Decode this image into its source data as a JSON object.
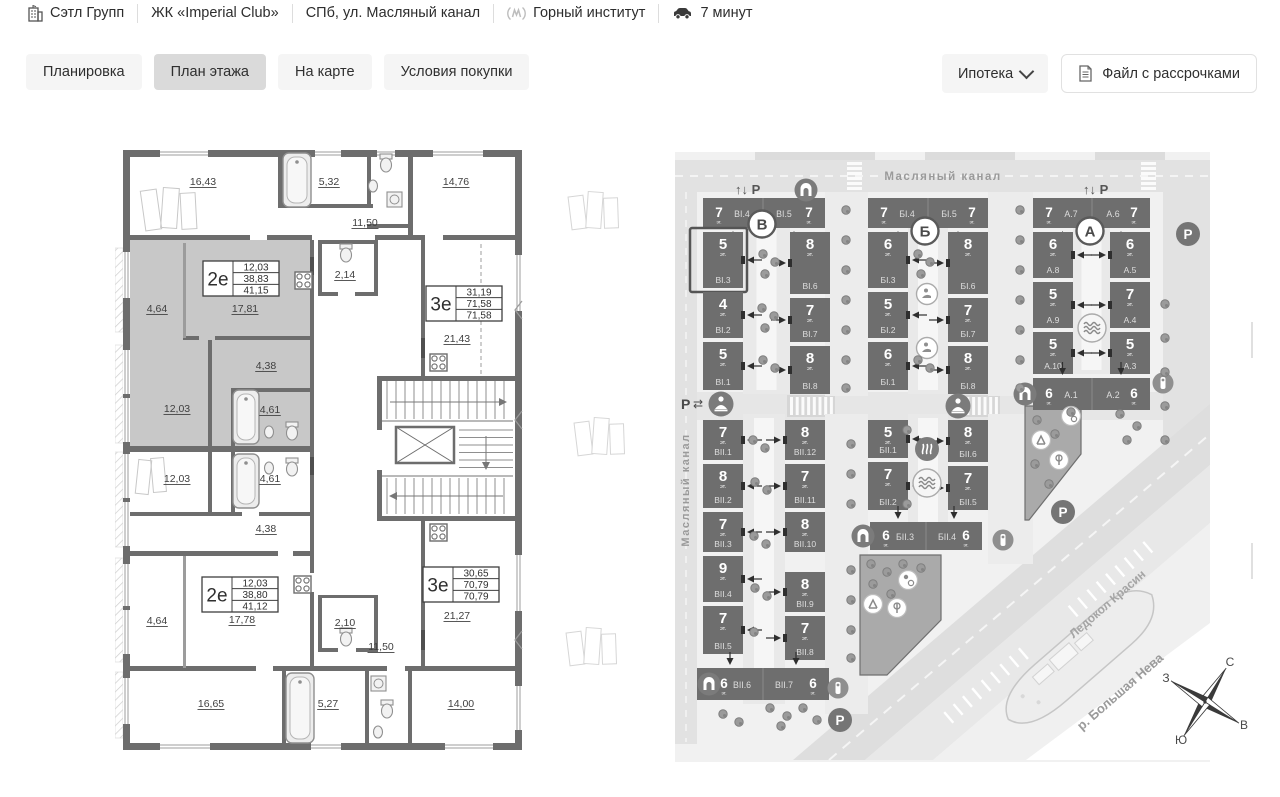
{
  "header": {
    "company": "Сэтл Групп",
    "complex": "ЖК «Imperial Club»",
    "address": "СПб, ул. Масляный канал",
    "metro": "Горный институт",
    "drive_time": "7 минут"
  },
  "tabs": [
    {
      "label": "Планировка",
      "active": false
    },
    {
      "label": "План этажа",
      "active": true
    },
    {
      "label": "На карте",
      "active": false
    },
    {
      "label": "Условия покупки",
      "active": false
    }
  ],
  "toolbar": {
    "mortgage_label": "Ипотека",
    "file_label": "Файл с рассрочками"
  },
  "floor_plan": {
    "unit_cards": [
      {
        "type": "2е",
        "areas": [
          "12,03",
          "38,83",
          "41,15"
        ],
        "x": 88,
        "y": 121
      },
      {
        "type": "3е",
        "areas": [
          "31,19",
          "71,58",
          "71,58"
        ],
        "x": 311,
        "y": 146
      },
      {
        "type": "2е",
        "areas": [
          "12,03",
          "38,80",
          "41,12"
        ],
        "x": 87,
        "y": 437
      },
      {
        "type": "3е",
        "areas": [
          "30,65",
          "70,79",
          "70,79"
        ],
        "x": 308,
        "y": 427
      }
    ],
    "room_labels": [
      {
        "t": "16,43",
        "x": 88,
        "y": 45
      },
      {
        "t": "5,32",
        "x": 214,
        "y": 45
      },
      {
        "t": "14,76",
        "x": 341,
        "y": 45
      },
      {
        "t": "11,50",
        "x": 250,
        "y": 86
      },
      {
        "t": "2,14",
        "x": 230,
        "y": 138
      },
      {
        "t": "4,64",
        "x": 42,
        "y": 172
      },
      {
        "t": "17,81",
        "x": 130,
        "y": 172
      },
      {
        "t": "4,38",
        "x": 151,
        "y": 229
      },
      {
        "t": "12,03",
        "x": 62,
        "y": 272
      },
      {
        "t": "4,61",
        "x": 155,
        "y": 273
      },
      {
        "t": "12,03",
        "x": 62,
        "y": 342
      },
      {
        "t": "4,61",
        "x": 155,
        "y": 342
      },
      {
        "t": "4,38",
        "x": 151,
        "y": 392
      },
      {
        "t": "21,43",
        "x": 342,
        "y": 202
      },
      {
        "t": "21,27",
        "x": 342,
        "y": 479
      },
      {
        "t": "17,78",
        "x": 127,
        "y": 483
      },
      {
        "t": "4,64",
        "x": 42,
        "y": 484
      },
      {
        "t": "2,10",
        "x": 230,
        "y": 486
      },
      {
        "t": "11,50",
        "x": 266,
        "y": 510
      },
      {
        "t": "16,65",
        "x": 96,
        "y": 567
      },
      {
        "t": "5,27",
        "x": 213,
        "y": 567
      },
      {
        "t": "14,00",
        "x": 346,
        "y": 567
      }
    ]
  },
  "site_map": {
    "streets": {
      "top": "Масляный канал",
      "left": "Масляный канал"
    },
    "river_label": "р. Большая Нева",
    "ship_label": "Ледокол Красин",
    "floors_suffix": "эт.",
    "parking_letter": "P",
    "entry_parking_label": "↑↓ P",
    "exchange_glyph": "⇄",
    "compass": {
      "north": "С",
      "east": "В",
      "south": "Ю",
      "west": "З"
    },
    "sections": [
      {
        "letter": "В",
        "x": 87,
        "y": 72
      },
      {
        "letter": "Б",
        "x": 250,
        "y": 79
      },
      {
        "letter": "А",
        "x": 415,
        "y": 79
      }
    ],
    "buildings": [
      {
        "label": "ВI.4",
        "floors": "7",
        "x": 28,
        "y": 46,
        "w": 60,
        "h": 30,
        "style": "nl",
        "entry": "b"
      },
      {
        "label": "ВI.5",
        "floors": "7",
        "x": 88,
        "y": 46,
        "w": 62,
        "h": 30,
        "style": "ln",
        "entry": "b"
      },
      {
        "label": "ВI.3",
        "floors": "5",
        "x": 28,
        "y": 80,
        "w": 40,
        "h": 56,
        "style": "col",
        "entry": "r",
        "selected": true
      },
      {
        "label": "ВI.2",
        "floors": "4",
        "x": 28,
        "y": 140,
        "w": 40,
        "h": 46,
        "style": "col",
        "entry": "r"
      },
      {
        "label": "ВI.1",
        "floors": "5",
        "x": 28,
        "y": 190,
        "w": 40,
        "h": 48,
        "style": "col",
        "entry": "r"
      },
      {
        "label": "ВI.6",
        "floors": "8",
        "x": 115,
        "y": 80,
        "w": 40,
        "h": 62,
        "style": "col",
        "entry": "l"
      },
      {
        "label": "ВI.7",
        "floors": "7",
        "x": 115,
        "y": 146,
        "w": 40,
        "h": 44,
        "style": "col",
        "entry": "l"
      },
      {
        "label": "ВI.8",
        "floors": "8",
        "x": 115,
        "y": 194,
        "w": 40,
        "h": 48,
        "style": "col",
        "entry": "l"
      },
      {
        "label": "БI.4",
        "floors": "7",
        "x": 193,
        "y": 46,
        "w": 60,
        "h": 30,
        "style": "nl",
        "entry": "b"
      },
      {
        "label": "БI.5",
        "floors": "7",
        "x": 253,
        "y": 46,
        "w": 60,
        "h": 30,
        "style": "ln",
        "entry": "b"
      },
      {
        "label": "БI.3",
        "floors": "6",
        "x": 193,
        "y": 80,
        "w": 40,
        "h": 56,
        "style": "col",
        "entry": "r"
      },
      {
        "label": "БI.2",
        "floors": "5",
        "x": 193,
        "y": 140,
        "w": 40,
        "h": 46,
        "style": "col",
        "entry": "r"
      },
      {
        "label": "БI.1",
        "floors": "6",
        "x": 193,
        "y": 190,
        "w": 40,
        "h": 48,
        "style": "col",
        "entry": "r"
      },
      {
        "label": "БI.6",
        "floors": "8",
        "x": 273,
        "y": 80,
        "w": 40,
        "h": 62,
        "style": "col",
        "entry": "l"
      },
      {
        "label": "БI.7",
        "floors": "7",
        "x": 273,
        "y": 146,
        "w": 40,
        "h": 44,
        "style": "col",
        "entry": "l"
      },
      {
        "label": "БI.8",
        "floors": "8",
        "x": 273,
        "y": 194,
        "w": 40,
        "h": 48,
        "style": "col",
        "entry": "l"
      },
      {
        "label": "А.7",
        "floors": "7",
        "x": 358,
        "y": 46,
        "w": 59,
        "h": 30,
        "style": "nl",
        "entry": "b"
      },
      {
        "label": "А.6",
        "floors": "7",
        "x": 417,
        "y": 46,
        "w": 58,
        "h": 30,
        "style": "ln",
        "entry": "b"
      },
      {
        "label": "А.8",
        "floors": "6",
        "x": 358,
        "y": 80,
        "w": 40,
        "h": 46,
        "style": "col",
        "entry": "r"
      },
      {
        "label": "А.9",
        "floors": "5",
        "x": 358,
        "y": 130,
        "w": 40,
        "h": 46,
        "style": "col",
        "entry": "r"
      },
      {
        "label": "А.10",
        "floors": "5",
        "x": 358,
        "y": 180,
        "w": 40,
        "h": 42,
        "style": "col",
        "entry": "r"
      },
      {
        "label": "А.5",
        "floors": "6",
        "x": 435,
        "y": 80,
        "w": 40,
        "h": 46,
        "style": "col",
        "entry": "l"
      },
      {
        "label": "А.4",
        "floors": "7",
        "x": 435,
        "y": 130,
        "w": 40,
        "h": 46,
        "style": "col",
        "entry": "l"
      },
      {
        "label": "А.3",
        "floors": "5",
        "x": 435,
        "y": 180,
        "w": 40,
        "h": 42,
        "style": "col",
        "entry": "l"
      },
      {
        "label": "А.1",
        "floors": "6",
        "x": 358,
        "y": 226,
        "w": 59,
        "h": 32,
        "style": "nl",
        "entry": "t"
      },
      {
        "label": "А.2",
        "floors": "6",
        "x": 417,
        "y": 226,
        "w": 58,
        "h": 32,
        "style": "ln",
        "entry": "t"
      },
      {
        "label": "ВII.1",
        "floors": "7",
        "x": 28,
        "y": 268,
        "w": 40,
        "h": 40,
        "style": "col",
        "entry": "r"
      },
      {
        "label": "ВII.2",
        "floors": "8",
        "x": 28,
        "y": 312,
        "w": 40,
        "h": 44,
        "style": "col",
        "entry": "r"
      },
      {
        "label": "ВII.3",
        "floors": "7",
        "x": 28,
        "y": 360,
        "w": 40,
        "h": 40,
        "style": "col",
        "entry": "r"
      },
      {
        "label": "ВII.4",
        "floors": "9",
        "x": 28,
        "y": 404,
        "w": 40,
        "h": 46,
        "style": "col",
        "entry": "r"
      },
      {
        "label": "ВII.5",
        "floors": "7",
        "x": 28,
        "y": 454,
        "w": 40,
        "h": 48,
        "style": "col",
        "entry": "r"
      },
      {
        "label": "ВII.12",
        "floors": "8",
        "x": 110,
        "y": 268,
        "w": 40,
        "h": 40,
        "style": "col",
        "entry": "l"
      },
      {
        "label": "ВII.11",
        "floors": "7",
        "x": 110,
        "y": 312,
        "w": 40,
        "h": 44,
        "style": "col",
        "entry": "l"
      },
      {
        "label": "ВII.10",
        "floors": "8",
        "x": 110,
        "y": 360,
        "w": 40,
        "h": 40,
        "style": "col",
        "entry": "l"
      },
      {
        "label": "ВII.9",
        "floors": "8",
        "x": 110,
        "y": 420,
        "w": 40,
        "h": 40,
        "style": "col",
        "entry": "l"
      },
      {
        "label": "ВII.8",
        "floors": "7",
        "x": 110,
        "y": 464,
        "w": 40,
        "h": 44,
        "style": "col",
        "entry": "l"
      },
      {
        "label": "ВII.6",
        "floors": "6",
        "x": 22,
        "y": 516,
        "w": 66,
        "h": 32,
        "style": "nl",
        "entry": "t",
        "nx": 27
      },
      {
        "label": "ВII.7",
        "floors": "6",
        "x": 88,
        "y": 516,
        "w": 66,
        "h": 32,
        "style": "ln",
        "entry": "t"
      },
      {
        "label": "БII.1",
        "floors": "5",
        "x": 193,
        "y": 268,
        "w": 40,
        "h": 38,
        "style": "col",
        "entry": "r"
      },
      {
        "label": "БII.2",
        "floors": "7",
        "x": 193,
        "y": 310,
        "w": 40,
        "h": 48,
        "style": "col",
        "entry": "r"
      },
      {
        "label": "БII.6",
        "floors": "8",
        "x": 273,
        "y": 268,
        "w": 40,
        "h": 42,
        "style": "col",
        "entry": "l"
      },
      {
        "label": "БII.5",
        "floors": "7",
        "x": 273,
        "y": 314,
        "w": 40,
        "h": 44,
        "style": "col",
        "entry": "l"
      },
      {
        "label": "БII.3",
        "floors": "6",
        "x": 195,
        "y": 370,
        "w": 56,
        "h": 28,
        "style": "nl",
        "entry": "t"
      },
      {
        "label": "БII.4",
        "floors": "6",
        "x": 251,
        "y": 370,
        "w": 56,
        "h": 28,
        "style": "ln",
        "entry": "t"
      }
    ],
    "features": [
      {
        "type": "entry-parking",
        "x": 60,
        "y": 42
      },
      {
        "type": "entry-parking",
        "x": 408,
        "y": 42
      },
      {
        "type": "parking",
        "x": 513,
        "y": 82
      },
      {
        "type": "parking",
        "x": 388,
        "y": 360
      },
      {
        "type": "parking",
        "x": 165,
        "y": 568
      },
      {
        "type": "side-parking",
        "x": 6,
        "y": 257
      },
      {
        "type": "yoga",
        "x": 46,
        "y": 252
      },
      {
        "type": "yoga",
        "x": 283,
        "y": 254
      },
      {
        "type": "spa",
        "x": 252,
        "y": 142
      },
      {
        "type": "spa",
        "x": 252,
        "y": 196
      },
      {
        "type": "hammam",
        "x": 252,
        "y": 297
      },
      {
        "type": "pool",
        "x": 252,
        "y": 331
      },
      {
        "type": "pool",
        "x": 417,
        "y": 176
      },
      {
        "type": "info",
        "x": 488,
        "y": 231
      },
      {
        "type": "info",
        "x": 328,
        "y": 388
      },
      {
        "type": "info",
        "x": 163,
        "y": 536
      },
      {
        "type": "arch",
        "x": 131,
        "y": 38
      },
      {
        "type": "arch",
        "x": 350,
        "y": 242
      },
      {
        "type": "arch",
        "x": 188,
        "y": 384
      },
      {
        "type": "arch",
        "x": 34,
        "y": 532
      },
      {
        "type": "play-slide",
        "x": 198,
        "y": 452
      },
      {
        "type": "play-hoop",
        "x": 222,
        "y": 456
      },
      {
        "type": "play-ball",
        "x": 233,
        "y": 428
      },
      {
        "type": "play-ball",
        "x": 396,
        "y": 264
      },
      {
        "type": "play-slide",
        "x": 366,
        "y": 288
      },
      {
        "type": "play-hoop",
        "x": 384,
        "y": 308
      }
    ]
  }
}
